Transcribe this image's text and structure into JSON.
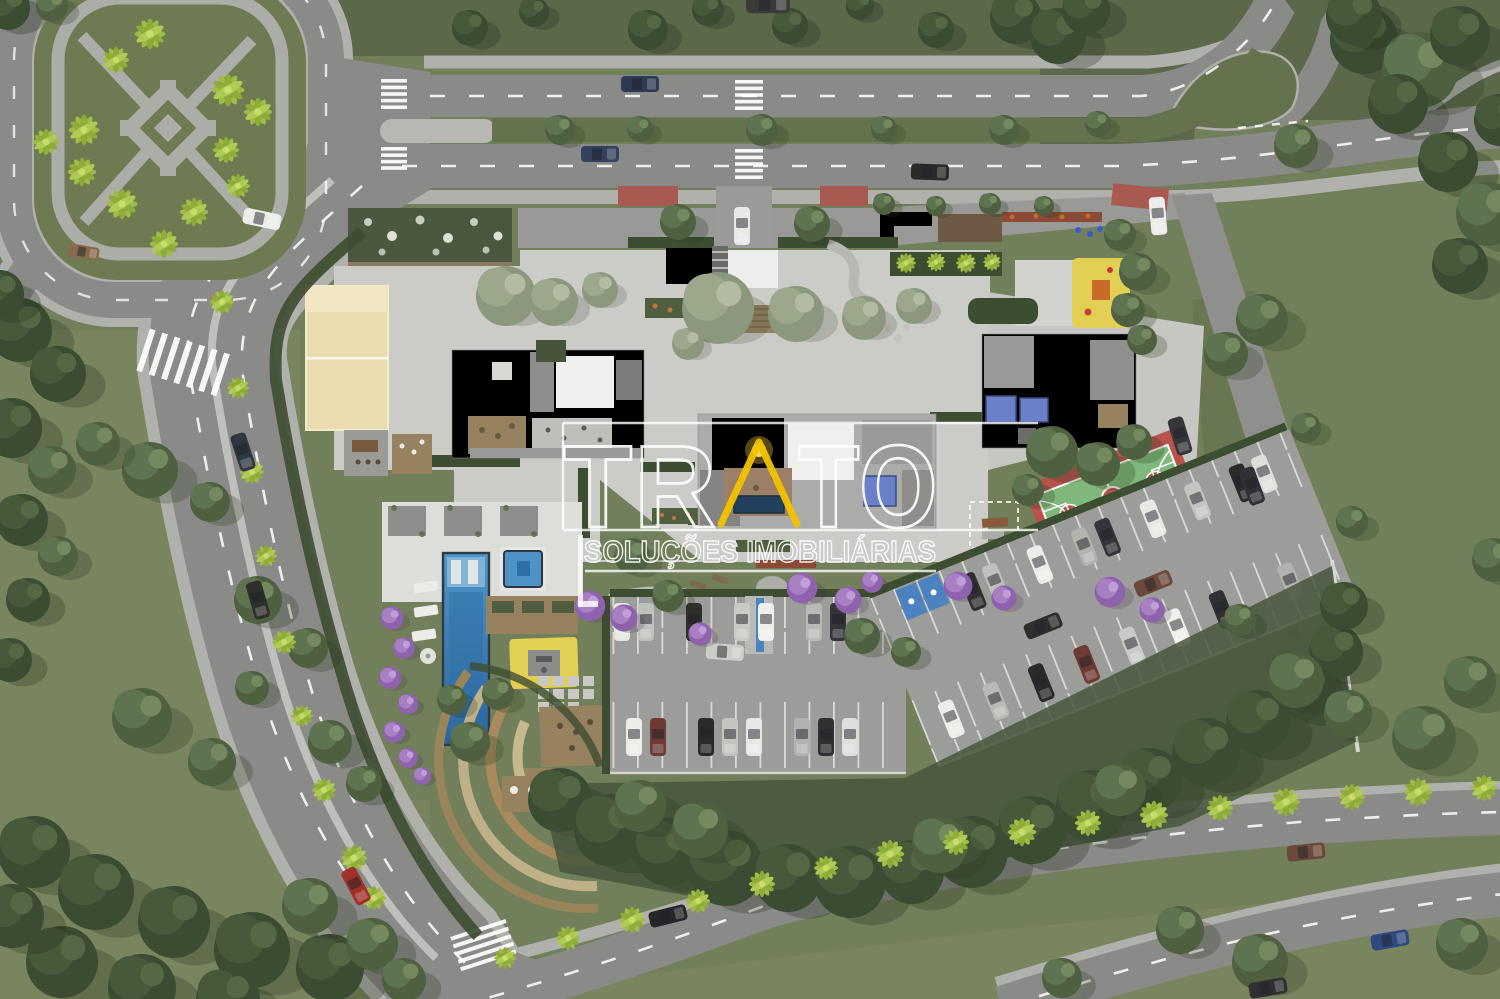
{
  "watermark": {
    "brand": "TRATO",
    "brand_left": "TR",
    "brand_right": "TO",
    "tagline": "SOLUÇÕES IMOBILIÁRIAS",
    "triangle_color": "#F2C200"
  },
  "palette": {
    "base_grass": "#71805A",
    "lawn": "#79855E",
    "dark_grass": "#5C684A",
    "park_grass": "#6E7B52",
    "median_green": "#64734E",
    "forest_dark": "#3C4C32",
    "tree_green": "#5E7350",
    "tree_pale": "#9CA88C",
    "palm_green": "#9FBC45",
    "jacaranda": "#A97FC4",
    "asphalt": "#8A8A88",
    "sidewalk": "#B0B0AD",
    "deck": "#CBCBC7",
    "pool_deck": "#DDDDD9",
    "sand": "#E9DDB0",
    "wood": "#96825F",
    "hedge": "#3D4D31",
    "pool_blue": "#3E86BB",
    "navy_pool": "#23405E",
    "solar_blue": "#6A80C8",
    "court_red": "#B9524A",
    "court_green": "#7FB87A",
    "entry_red": "#A85A50",
    "play_yellow": "#E4CF55",
    "parking": "#9C9C9A",
    "stripe_white": "#DCDCD8",
    "handicap_blue": "#3E7EC6",
    "watermark_white": "#FFFFFF",
    "watermark_yellow": "#F2C200"
  }
}
